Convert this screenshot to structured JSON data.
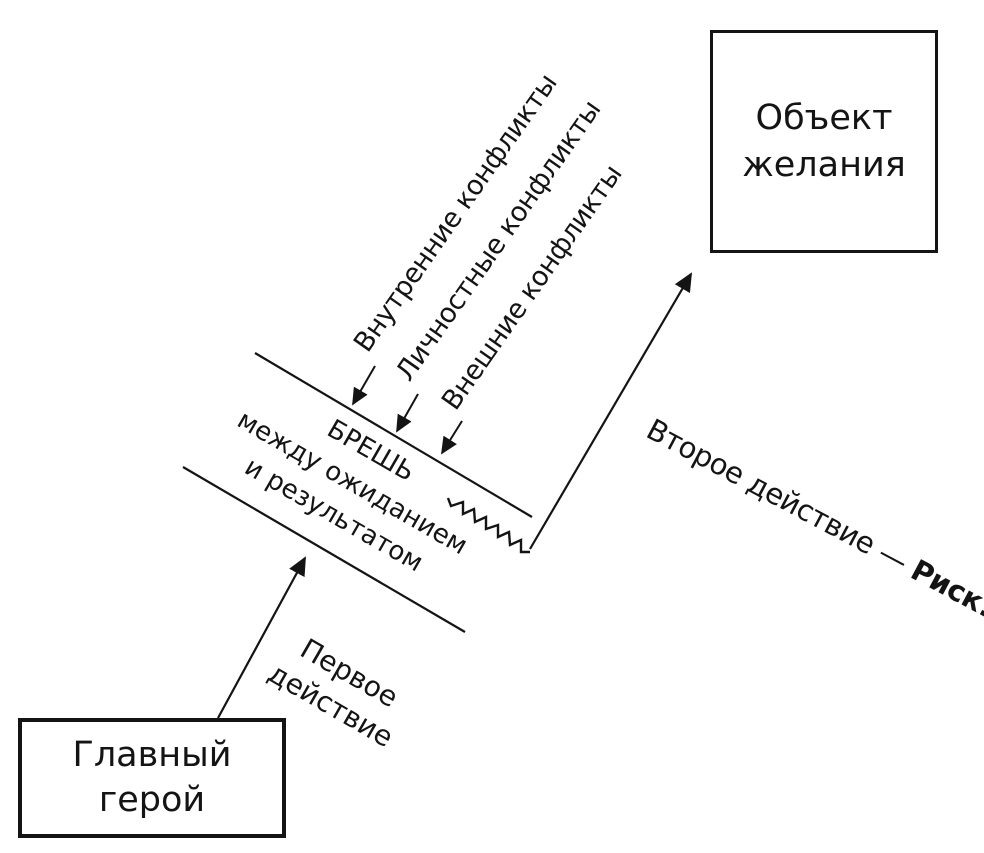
{
  "colors": {
    "ink": "#141414",
    "background": "#ffffff"
  },
  "object_box": {
    "line1": "Объект",
    "line2": "желания"
  },
  "hero_box": {
    "line1": "Главный",
    "line2": "герой"
  },
  "gap": {
    "line1": "БРЕШЬ",
    "line2": "между ожиданием",
    "line3": "и результатом"
  },
  "first_action": {
    "line1": "Первое",
    "line2": "действие"
  },
  "second_action": {
    "text": "Второе действие — ",
    "emphasis": "Риск!"
  },
  "conflicts": {
    "internal": "Внутренние конфликты",
    "personal": "Личностные конфликты",
    "external": "Внешние конфликты"
  }
}
